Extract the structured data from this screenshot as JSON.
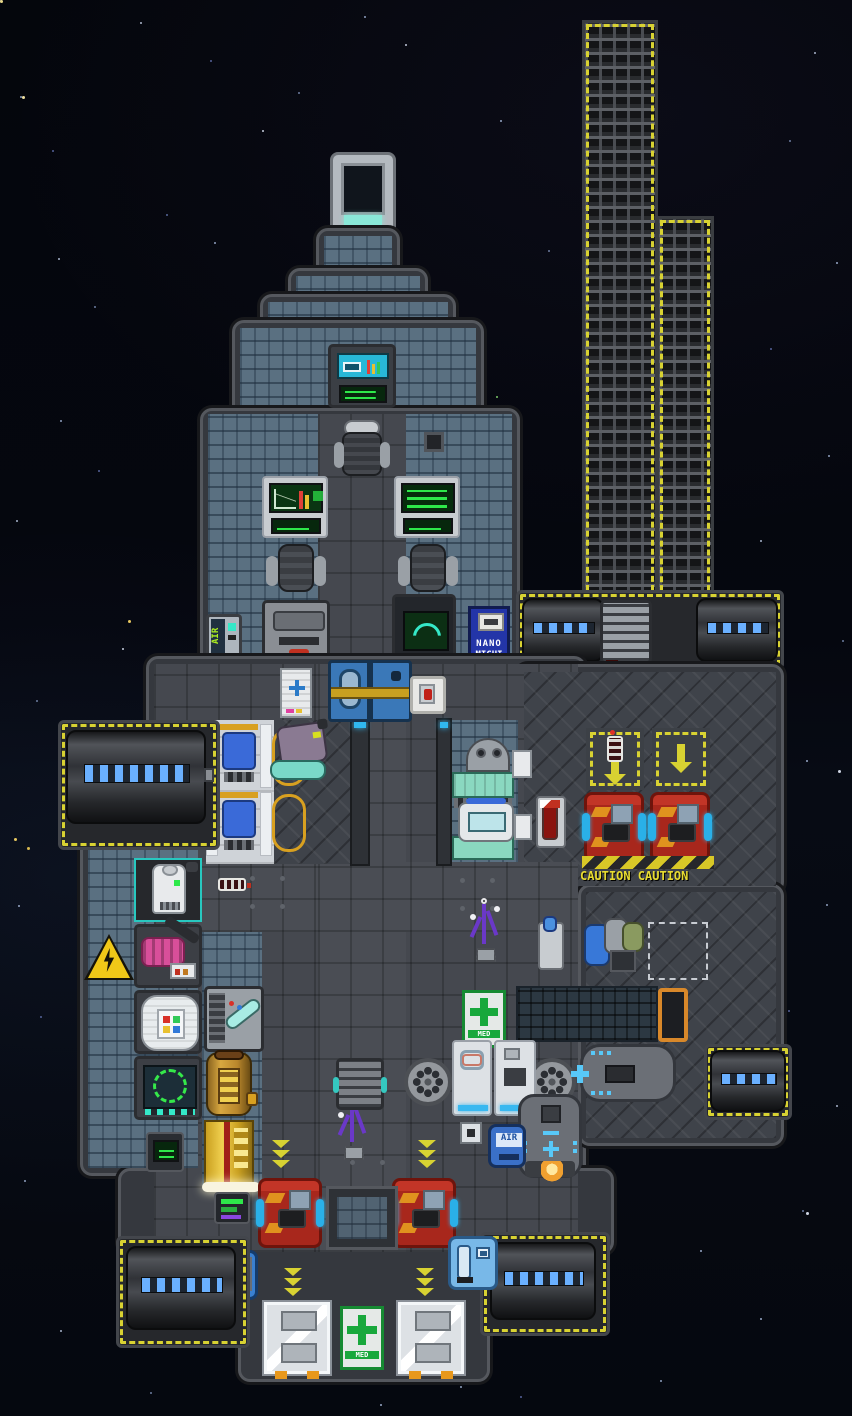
{
  "scene": {
    "type": "space-station-game-map",
    "background": "#05070e",
    "description": "Top-down pixel-art spaceship floorplan floating in a starfield"
  },
  "palette": {
    "hull": "#35383e",
    "hull_edge": "#55585e",
    "plating_blue_gray": "#5a7081",
    "floor_dark": "#45484f",
    "accent_yellow": "#d8d232",
    "hazard_yellow": "#d8c827",
    "crate_red": "#a8271c",
    "sign_blue": "#2335a8",
    "eva_sign_blue": "#8ca6e0",
    "med_green": "#18a83c",
    "tank_light_blue": "#6ab0ff",
    "flame_orange": "#f0a030"
  },
  "signs": {
    "nanomed": {
      "line1": "NANO",
      "line2": "MICHI"
    },
    "eva": {
      "label": "KOCM"
    },
    "caution_floor": {
      "label": "CAUTION CAUTION"
    },
    "air_dispenser": {
      "label": "AIR"
    },
    "air_warning": {
      "label": "AIR"
    },
    "air_canister": {
      "label": "AIR"
    },
    "med_bottom": {
      "label": "MED"
    },
    "med_right": {
      "label": "MED"
    }
  },
  "icons": {
    "chevron_down": "triple yellow chevrons",
    "arrow_down": "yellow arrow",
    "blue_cross": "first aid cross",
    "green_cross": "medical cross",
    "lightning_bolt": "high voltage",
    "battery": "cell charge indicator"
  }
}
